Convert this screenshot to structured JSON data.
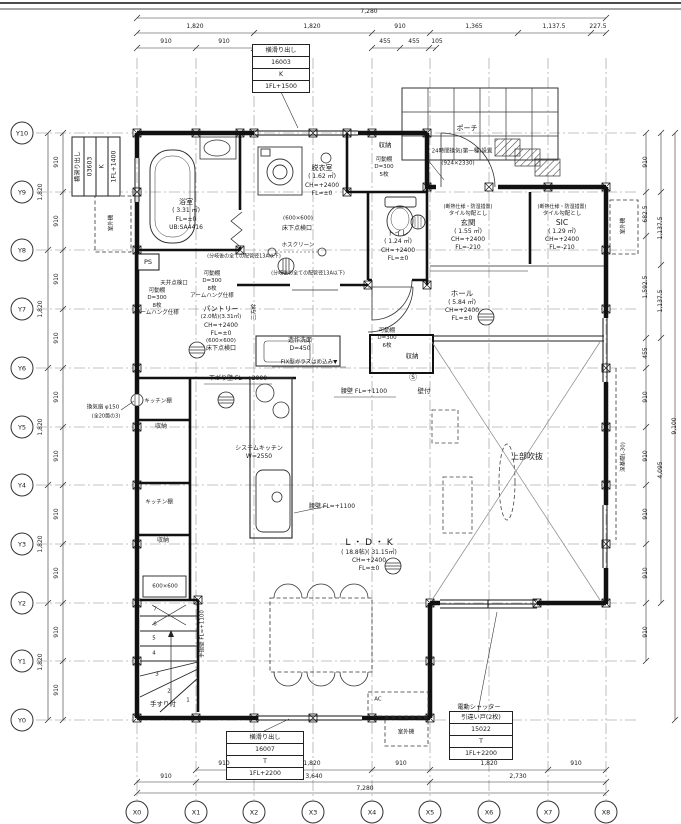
{
  "page": {
    "bg": "#ffffff",
    "ink": "#1a1a1a"
  },
  "grid": {
    "x": [
      {
        "label": "X0",
        "pos": 137
      },
      {
        "label": "X1",
        "pos": 196
      },
      {
        "label": "X2",
        "pos": 254
      },
      {
        "label": "X3",
        "pos": 313
      },
      {
        "label": "X4",
        "pos": 372
      },
      {
        "label": "X5",
        "pos": 430
      },
      {
        "label": "X6",
        "pos": 489
      },
      {
        "label": "X7",
        "pos": 548
      },
      {
        "label": "X8",
        "pos": 606
      }
    ],
    "y": [
      {
        "label": "Y10",
        "pos": 133
      },
      {
        "label": "Y9",
        "pos": 192
      },
      {
        "label": "Y8",
        "pos": 250
      },
      {
        "label": "Y7",
        "pos": 309
      },
      {
        "label": "Y6",
        "pos": 368
      },
      {
        "label": "Y5",
        "pos": 427
      },
      {
        "label": "Y4",
        "pos": 485
      },
      {
        "label": "Y3",
        "pos": 544
      },
      {
        "label": "Y2",
        "pos": 603
      },
      {
        "label": "Y1",
        "pos": 661
      },
      {
        "label": "Y0",
        "pos": 720
      }
    ]
  },
  "window_specs": {
    "top": {
      "rows": [
        "横滑り出し",
        "16003",
        "K",
        "1FL+1500"
      ]
    },
    "left": {
      "rows": [
        "横滑り出し",
        "03603",
        "K",
        "1FL+1400"
      ]
    },
    "bottom": {
      "rows": [
        "横滑り出し",
        "16007",
        "T",
        "1FL+2200"
      ]
    },
    "shutter": {
      "title": "電動シャッター",
      "rows": [
        "引違い戸(2枚)",
        "15022",
        "T",
        "1FL+2200"
      ]
    }
  },
  "dim_labels": [
    {
      "t": "7,280",
      "x": 369,
      "y": 12
    },
    {
      "t": "1,820",
      "x": 195,
      "y": 27
    },
    {
      "t": "1,820",
      "x": 312,
      "y": 27
    },
    {
      "t": "910",
      "x": 400,
      "y": 27
    },
    {
      "t": "1,365",
      "x": 474,
      "y": 27
    },
    {
      "t": "1,137.5",
      "x": 554,
      "y": 27
    },
    {
      "t": "227.5",
      "x": 598,
      "y": 27
    },
    {
      "t": "910",
      "x": 166,
      "y": 42
    },
    {
      "t": "910",
      "x": 224,
      "y": 42
    },
    {
      "t": "455",
      "x": 385,
      "y": 42
    },
    {
      "t": "455",
      "x": 414,
      "y": 42
    },
    {
      "t": "105",
      "x": 437,
      "y": 42
    },
    {
      "t": "910",
      "x": 224,
      "y": 764
    },
    {
      "t": "1,820",
      "x": 312,
      "y": 764
    },
    {
      "t": "910",
      "x": 401,
      "y": 764
    },
    {
      "t": "1,820",
      "x": 489,
      "y": 764
    },
    {
      "t": "910",
      "x": 576,
      "y": 764
    },
    {
      "t": "910",
      "x": 166,
      "y": 777
    },
    {
      "t": "3,640",
      "x": 314,
      "y": 777
    },
    {
      "t": "2,730",
      "x": 518,
      "y": 777
    },
    {
      "t": "7,280",
      "x": 365,
      "y": 789
    },
    {
      "t": "1,820",
      "x": 41,
      "y": 192,
      "rot": 1
    },
    {
      "t": "1,820",
      "x": 41,
      "y": 309,
      "rot": 1
    },
    {
      "t": "1,820",
      "x": 41,
      "y": 427,
      "rot": 1
    },
    {
      "t": "1,820",
      "x": 41,
      "y": 544,
      "rot": 1
    },
    {
      "t": "1,820",
      "x": 41,
      "y": 662,
      "rot": 1
    },
    {
      "t": "910",
      "x": 57,
      "y": 162,
      "rot": 1
    },
    {
      "t": "910",
      "x": 57,
      "y": 221,
      "rot": 1
    },
    {
      "t": "910",
      "x": 57,
      "y": 279,
      "rot": 1
    },
    {
      "t": "910",
      "x": 57,
      "y": 338,
      "rot": 1
    },
    {
      "t": "910",
      "x": 57,
      "y": 397,
      "rot": 1
    },
    {
      "t": "910",
      "x": 57,
      "y": 456,
      "rot": 1
    },
    {
      "t": "910",
      "x": 57,
      "y": 514,
      "rot": 1
    },
    {
      "t": "910",
      "x": 57,
      "y": 573,
      "rot": 1
    },
    {
      "t": "910",
      "x": 57,
      "y": 632,
      "rot": 1
    },
    {
      "t": "910",
      "x": 57,
      "y": 690,
      "rot": 1
    },
    {
      "t": "910",
      "x": 646,
      "y": 162,
      "rot": 1
    },
    {
      "t": "682.5",
      "x": 646,
      "y": 214,
      "rot": 1
    },
    {
      "t": "1,592.5",
      "x": 646,
      "y": 287,
      "rot": 1
    },
    {
      "t": "455",
      "x": 646,
      "y": 353,
      "rot": 1
    },
    {
      "t": "910",
      "x": 646,
      "y": 397,
      "rot": 1
    },
    {
      "t": "910",
      "x": 646,
      "y": 456,
      "rot": 1
    },
    {
      "t": "910",
      "x": 646,
      "y": 514,
      "rot": 1
    },
    {
      "t": "910",
      "x": 646,
      "y": 573,
      "rot": 1
    },
    {
      "t": "910",
      "x": 646,
      "y": 632,
      "rot": 1
    },
    {
      "t": "1,137.5",
      "x": 661,
      "y": 228,
      "rot": 1
    },
    {
      "t": "1,137.5",
      "x": 661,
      "y": 301,
      "rot": 1
    },
    {
      "t": "4,095",
      "x": 661,
      "y": 470,
      "rot": 1
    },
    {
      "t": "9,100",
      "x": 675,
      "y": 426,
      "rot": 1
    }
  ],
  "text_blocks": [
    {
      "name": "room-bath",
      "x": 186,
      "y": 198,
      "lines": [
        {
          "t": "浴室",
          "fs": 7
        },
        {
          "t": "( 3.31 ㎡)",
          "fs": 6
        },
        {
          "t": "FL=±0",
          "fs": 6
        },
        {
          "t": "UB:SA4416",
          "fs": 6
        }
      ]
    },
    {
      "name": "room-dressing",
      "x": 322,
      "y": 164,
      "lines": [
        {
          "t": "脱衣室",
          "fs": 7
        },
        {
          "t": "( 1.62 ㎡)",
          "fs": 6
        },
        {
          "t": "CH=+2400",
          "fs": 6
        },
        {
          "t": "FL=±0",
          "fs": 6
        }
      ]
    },
    {
      "name": "room-toilet",
      "x": 398,
      "y": 229,
      "lines": [
        {
          "t": "トイレ",
          "fs": 7
        },
        {
          "t": "( 1.24 ㎡)",
          "fs": 6
        },
        {
          "t": "CH=+2400",
          "fs": 6
        },
        {
          "t": "FL=±0",
          "fs": 6
        }
      ]
    },
    {
      "name": "room-genkan",
      "x": 468,
      "y": 204,
      "lines": [
        {
          "t": "(断熱仕様・防湿措置)",
          "fs": 5
        },
        {
          "t": "タイル勾配とし",
          "fs": 5.5
        },
        {
          "t": "玄関",
          "fs": 7.5
        },
        {
          "t": "( 1.55 ㎡)",
          "fs": 6
        },
        {
          "t": "CH=+2400",
          "fs": 6
        },
        {
          "t": "FL=-210",
          "fs": 6
        }
      ]
    },
    {
      "name": "room-sic",
      "x": 562,
      "y": 204,
      "lines": [
        {
          "t": "(断熱仕様・防湿措置)",
          "fs": 5
        },
        {
          "t": "タイル勾配とし",
          "fs": 5.5
        },
        {
          "t": "SIC",
          "fs": 7.5
        },
        {
          "t": "( 1.29 ㎡)",
          "fs": 6
        },
        {
          "t": "CH=+2400",
          "fs": 6
        },
        {
          "t": "FL=-210",
          "fs": 6
        }
      ]
    },
    {
      "name": "room-hall",
      "x": 462,
      "y": 289,
      "lines": [
        {
          "t": "ホール",
          "fs": 7.5
        },
        {
          "t": "( 5.84 ㎡)",
          "fs": 6
        },
        {
          "t": "CH=+2400",
          "fs": 6
        },
        {
          "t": "FL=±0",
          "fs": 6
        }
      ]
    },
    {
      "name": "room-pantry",
      "x": 221,
      "y": 305,
      "lines": [
        {
          "t": "パントリー",
          "fs": 7
        },
        {
          "t": "(2.0帖)(3.31㎡)",
          "fs": 5.5
        },
        {
          "t": "CH=+2400",
          "fs": 6
        },
        {
          "t": "FL=±0",
          "fs": 6
        },
        {
          "t": "(600×600)",
          "fs": 5.5
        },
        {
          "t": "床下点検口",
          "fs": 6
        }
      ]
    },
    {
      "name": "room-ldk",
      "x": 369,
      "y": 537,
      "lines": [
        {
          "t": "L ・ D ・ K",
          "fs": 9
        },
        {
          "t": "( 18.8帖)( 31.15㎡)",
          "fs": 6
        },
        {
          "t": "CH=+2400",
          "fs": 6
        },
        {
          "t": "FL=±0",
          "fs": 6
        }
      ]
    },
    {
      "name": "shelf-closet-top",
      "x": 384,
      "y": 157,
      "lines": [
        {
          "t": "可動棚",
          "fs": 5.5
        },
        {
          "t": "D=300",
          "fs": 5.5
        },
        {
          "t": "5枚",
          "fs": 5.5
        }
      ]
    },
    {
      "name": "shelf-hall-closet",
      "x": 387,
      "y": 328,
      "lines": [
        {
          "t": "可動棚",
          "fs": 5.5
        },
        {
          "t": "D=300",
          "fs": 5.5
        },
        {
          "t": "6枚",
          "fs": 5.5
        }
      ]
    },
    {
      "name": "shelf-pantry-top",
      "x": 212,
      "y": 271,
      "lines": [
        {
          "t": "可動棚",
          "fs": 5.5
        },
        {
          "t": "D=300",
          "fs": 5.5
        },
        {
          "t": "8枚",
          "fs": 5.5
        },
        {
          "t": "アームハング仕様",
          "fs": 5.5
        }
      ]
    },
    {
      "name": "shelf-left",
      "x": 157,
      "y": 288,
      "lines": [
        {
          "t": "可動棚",
          "fs": 5.5
        },
        {
          "t": "D=300",
          "fs": 5.5
        },
        {
          "t": "8枚",
          "fs": 5.5
        },
        {
          "t": "アームハング仕様",
          "fs": 5.5
        }
      ]
    },
    {
      "name": "washbasin-label",
      "x": 300,
      "y": 337,
      "lines": [
        {
          "t": "造作洗面",
          "fs": 6
        },
        {
          "t": "D=450",
          "fs": 6
        }
      ]
    },
    {
      "name": "kitchen-label",
      "x": 259,
      "y": 445,
      "lines": [
        {
          "t": "システムキッチン",
          "fs": 6
        },
        {
          "t": "W=2550",
          "fs": 6
        }
      ]
    }
  ],
  "annotations": [
    {
      "t": "ポーチ",
      "x": 467,
      "y": 129,
      "fs": 7
    },
    {
      "t": "24時間換気(第一種)設置",
      "x": 462,
      "y": 152,
      "fs": 5.5
    },
    {
      "t": "(924×2330)",
      "x": 458,
      "y": 164,
      "fs": 5.5
    },
    {
      "t": "収納",
      "x": 385,
      "y": 145,
      "fs": 6.5
    },
    {
      "t": "収納",
      "x": 412,
      "y": 356,
      "fs": 6.5
    },
    {
      "t": "上部吹抜",
      "x": 527,
      "y": 457,
      "fs": 8
    },
    {
      "t": "ホスクリーン",
      "x": 298,
      "y": 246,
      "fs": 5.5
    },
    {
      "t": "(600×600)",
      "x": 298,
      "y": 219,
      "fs": 5.5
    },
    {
      "t": "床下点検口",
      "x": 297,
      "y": 229,
      "fs": 6
    },
    {
      "t": "(分岐後の全ての配管径13A以下)",
      "x": 244,
      "y": 257,
      "fs": 5
    },
    {
      "t": "(分岐後の全ての配管径13A以下)",
      "x": 308,
      "y": 274,
      "fs": 5
    },
    {
      "t": "天井点検口",
      "x": 174,
      "y": 284,
      "fs": 5.5
    },
    {
      "t": "Ⓢ",
      "x": 413,
      "y": 378,
      "fs": 8
    },
    {
      "t": "壁付",
      "x": 424,
      "y": 391,
      "fs": 6.5
    },
    {
      "t": "腰壁 FL=+1100",
      "x": 364,
      "y": 392,
      "fs": 6
    },
    {
      "t": "腰壁 FL=+1100",
      "x": 332,
      "y": 507,
      "fs": 6
    },
    {
      "t": "下がり壁 FL=+2000",
      "x": 238,
      "y": 379,
      "fs": 6
    },
    {
      "t": "FIX型ガラスはめ込み▼",
      "x": 309,
      "y": 363,
      "fs": 5.5
    },
    {
      "t": "三方枠",
      "x": 255,
      "y": 312,
      "fs": 5.5,
      "rot": 1
    },
    {
      "t": "PS",
      "x": 148,
      "y": 262,
      "fs": 6.5
    },
    {
      "t": "室外機",
      "x": 112,
      "y": 223,
      "fs": 5.5,
      "rot": 1
    },
    {
      "t": "室外機",
      "x": 406,
      "y": 733,
      "fs": 5.5
    },
    {
      "t": "室外機",
      "x": 624,
      "y": 226,
      "fs": 5.5,
      "rot": 1
    },
    {
      "t": "AC",
      "x": 378,
      "y": 700,
      "fs": 5.5
    },
    {
      "t": "換気扇 φ150",
      "x": 103,
      "y": 408,
      "fs": 5.5
    },
    {
      "t": "(全20箇の3)",
      "x": 106,
      "y": 417,
      "fs": 5
    },
    {
      "t": "手すり付",
      "x": 163,
      "y": 704,
      "fs": 6.5
    },
    {
      "t": "600×600",
      "x": 165,
      "y": 587,
      "fs": 5.5
    },
    {
      "t": "手摺壁 FL=+1100",
      "x": 203,
      "y": 634,
      "fs": 5.5,
      "rot": 1
    },
    {
      "t": "深基礎(-30)",
      "x": 624,
      "y": 457,
      "fs": 5.5,
      "rot": 1
    },
    {
      "t": "キッチン棚",
      "x": 158,
      "y": 402,
      "fs": 5.5
    },
    {
      "t": "収納",
      "x": 161,
      "y": 427,
      "fs": 6
    },
    {
      "t": "キッチン棚",
      "x": 159,
      "y": 503,
      "fs": 5.5
    },
    {
      "t": "収納",
      "x": 163,
      "y": 541,
      "fs": 6
    },
    {
      "t": "7",
      "x": 155,
      "y": 610,
      "fs": 5.5
    },
    {
      "t": "6",
      "x": 155,
      "y": 625,
      "fs": 5.5
    },
    {
      "t": "5",
      "x": 154,
      "y": 639,
      "fs": 5.5
    },
    {
      "t": "4",
      "x": 154,
      "y": 654,
      "fs": 5.5
    },
    {
      "t": "3",
      "x": 157,
      "y": 675,
      "fs": 5.5
    },
    {
      "t": "2",
      "x": 169,
      "y": 692,
      "fs": 5.5
    },
    {
      "t": "1",
      "x": 188,
      "y": 701,
      "fs": 5.5
    }
  ]
}
